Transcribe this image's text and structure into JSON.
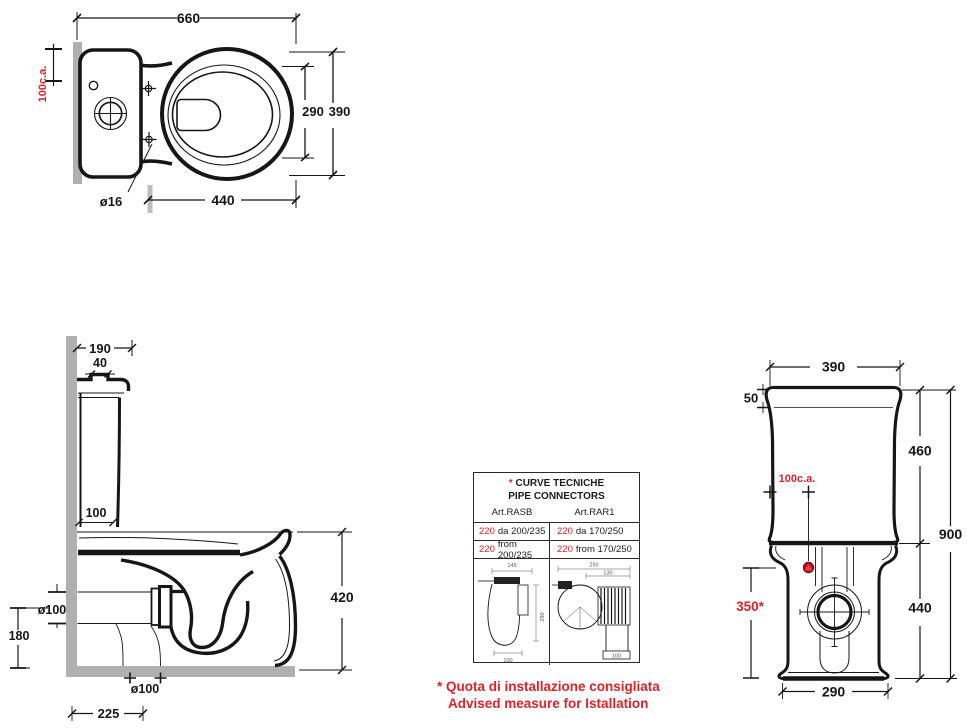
{
  "colors": {
    "red": "#e02227",
    "wall_gray": "#b0b0b0",
    "line": "#161616"
  },
  "top_view": {
    "dim_total_width": "660",
    "dim_seat_inner_width": "290",
    "dim_bowl_width": "390",
    "dim_bowl_length": "440",
    "dim_fixing_hole": "ø16",
    "dim_wall_distance": "100c.a."
  },
  "side_view": {
    "dim_tank_depth": "190",
    "dim_lid_knob": "40",
    "dim_wall_to_front": "100",
    "dim_rim_height": "420",
    "dim_wall_outlet": "ø100",
    "dim_outlet_height": "180",
    "dim_floor_outlet": "ø100",
    "dim_floor_outlet_distance": "225"
  },
  "front_view": {
    "dim_tank_width": "390",
    "dim_lid_height": "50",
    "dim_tank_height": "460",
    "dim_total_height": "900",
    "dim_bowl_height": "440",
    "dim_base_width": "290",
    "dim_inlet": "100c.a.",
    "dim_install_height": "350*"
  },
  "connectors_table": {
    "asterisk": "*",
    "title_line1": "CURVE TECNICHE",
    "title_line2": "PIPE CONNECTORS",
    "col_left": "Art.RASB",
    "col_right": "Art.RAR1",
    "rows": [
      {
        "left_red": "220",
        "left_text": "da 200/235",
        "right_red": "220",
        "right_text": "da 170/250"
      },
      {
        "left_red": "220",
        "left_text": "from 200/235",
        "right_red": "220",
        "right_text": "from 170/250"
      }
    ],
    "drawing_left": {
      "dim_top": "145",
      "dim_side": "290",
      "dim_bottom": "100"
    },
    "drawing_right": {
      "dim_top": "250",
      "dim_inner": "130",
      "dim_bottom": "100"
    }
  },
  "footnote": {
    "line1_it": "* Quota di installazione consigliata",
    "line2_en": "Advised measure for Istallation"
  }
}
